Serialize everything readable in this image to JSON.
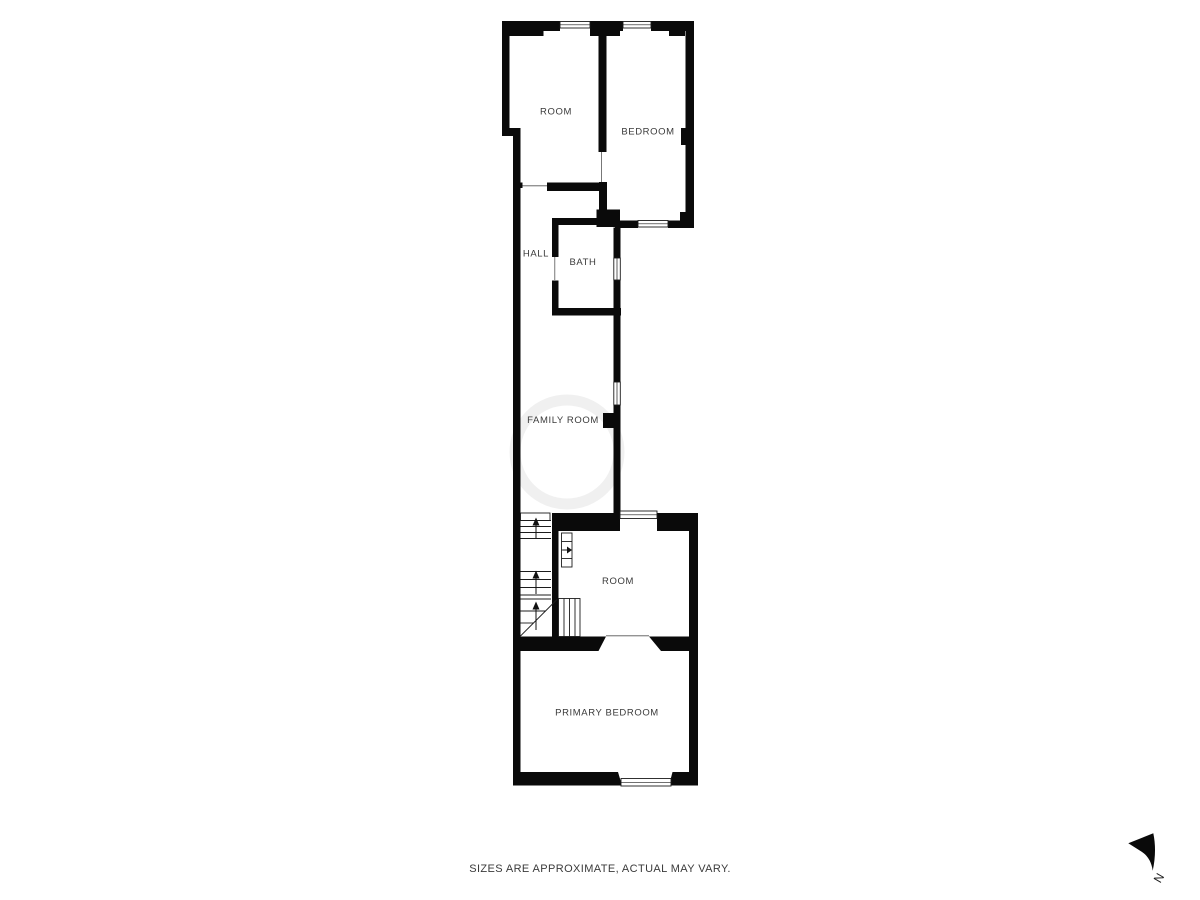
{
  "floor_plan": {
    "rooms": [
      {
        "id": "room-top",
        "label": "ROOM"
      },
      {
        "id": "bedroom",
        "label": "BEDROOM"
      },
      {
        "id": "hall",
        "label": "HALL"
      },
      {
        "id": "bath",
        "label": "BATH"
      },
      {
        "id": "family-room",
        "label": "FAMILY ROOM"
      },
      {
        "id": "room-lower",
        "label": "ROOM"
      },
      {
        "id": "primary-bedroom",
        "label": "PRIMARY BEDROOM"
      }
    ]
  },
  "compass": {
    "label": "N"
  },
  "footer": {
    "disclaimer": "SIZES ARE APPROXIMATE, ACTUAL MAY VARY."
  },
  "colors": {
    "wall": "#0a0a0a",
    "label_text": "#3a3a3a",
    "background": "#ffffff"
  }
}
